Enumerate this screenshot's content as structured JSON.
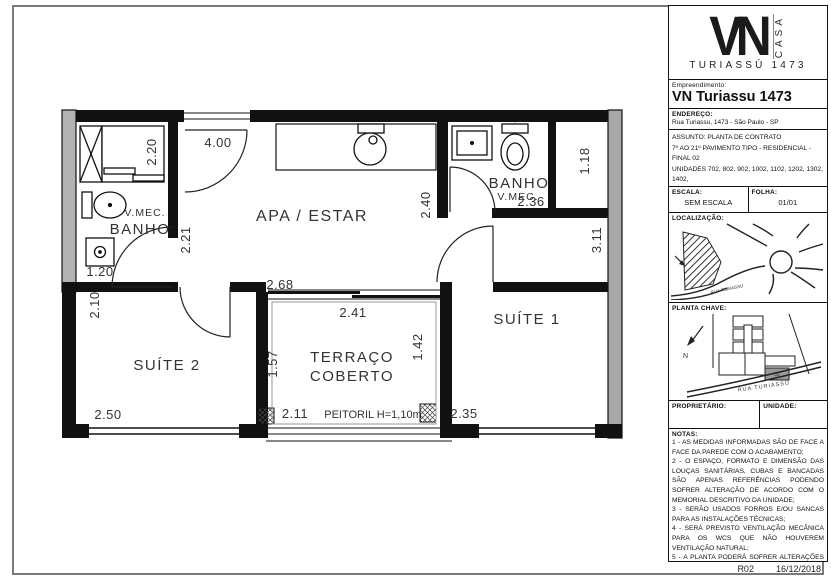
{
  "sheet": {
    "revision": "R02",
    "date": "16/12/2018"
  },
  "title_block": {
    "logo": {
      "monogram": "VN",
      "casa_vertical": "CASA",
      "subtitle": "TURIASSÚ 1473"
    },
    "empreendimento": {
      "label": "Empreendimento:",
      "value": "VN Turiassu 1473"
    },
    "endereco": {
      "label": "ENDEREÇO:",
      "value": "Rua Turiassu, 1473 - São Paulo - SP"
    },
    "assunto": {
      "lines": [
        "ASSUNTO: PLANTA DE CONTRATO",
        "7º AO 21º PAVIMENTO TIPO - RESIDENCIAL - FINAL 02",
        "UNIDADES 702, 802, 902, 1002, 1102, 1202, 1302, 1402,",
        "1502, 1602, 1702, 1802, 1902, 2002 E 2102",
        "ÁREA PRIVATIVA - 38,94m²"
      ]
    },
    "escala": {
      "label": "ESCALA:",
      "value": "SEM ESCALA"
    },
    "folha": {
      "label": "FOLHA:",
      "value": "01/01"
    },
    "localizacao": {
      "label": "LOCALIZAÇÃO:",
      "road_label": "RUA TURIASSU"
    },
    "planta_chave": {
      "label": "PLANTA CHAVE:",
      "north_label": "N",
      "road_label": "RUA TURIASSU",
      "unit_label": "02"
    },
    "proprietario": {
      "label": "PROPRIETÁRIO:"
    },
    "unidade": {
      "label": "UNIDADE:"
    },
    "notas": {
      "label": "NOTAS:",
      "items": [
        "1 - AS MEDIDAS INFORMADAS SÃO DE FACE A FACE DA PAREDE COM O ACABAMENTO;",
        "2 - O ESPAÇO, FORMATO E DIMENSÃO DAS LOUÇAS SANITÁRIAS, CUBAS E BANCADAS SÃO APENAS REFERÊNCIAS PODENDO SOFRER ALTERAÇÃO DE ACORDO COM O MEMORIAL DESCRITIVO DA UNIDADE;",
        "3 - SERÃO USADOS FORROS E/OU SANCAS PARA AS INSTALAÇÕES TÉCNICAS;",
        "4 - SERÁ PREVISTO VENTILAÇÃO MECÂNICA PARA OS WCS QUE NÃO HOUVEREM VENTILAÇÃO NATURAL;",
        "5 - A PLANTA PODERÁ SOFRER ALTERAÇÕES DEVIDO AS ADAPTAÇÕES TÉCNICAS NECESSÁRIAS NO DESENVOLVIMENTO DO PROJETO EXECUTIVO, NÃO DEVENDO ASSIM SER USADA COMO REFERÊNCIA PARA COMPRA DE MÓVEIS."
      ]
    }
  },
  "plan": {
    "rooms": {
      "apa_estar": "APA / ESTAR",
      "suite1": "SUÍTE 1",
      "suite2": "SUÍTE 2",
      "terraco_line1": "TERRAÇO",
      "terraco_line2": "COBERTO",
      "banho_left": "BANHO",
      "vmec_left": "V.MEC.",
      "banho_right": "BANHO",
      "vmec_right": "V.MEC."
    },
    "dims": {
      "d400": "4.00",
      "d220": "2.20",
      "d221": "2.21",
      "d240": "2.40",
      "d236": "2.36",
      "d118": "1.18",
      "d311": "3.11",
      "d120": "1.20",
      "d210": "2.10",
      "d250": "2.50",
      "d268": "2.68",
      "d241": "2.41",
      "d157": "1.57",
      "d142": "1.42",
      "d211": "2.11",
      "d235": "2.35"
    },
    "peitoril": "PEITORIL H=1,10m"
  },
  "colors": {
    "wall": "#111111",
    "concrete": "#a8a8a8",
    "line": "#222222"
  }
}
